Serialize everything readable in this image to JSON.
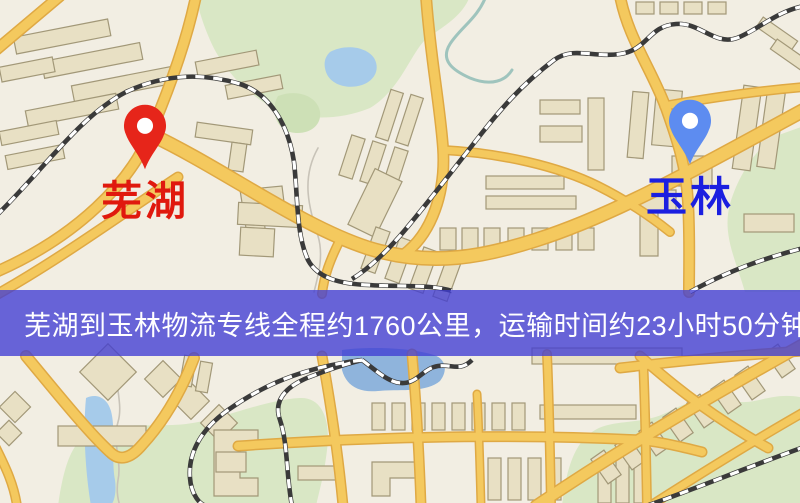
{
  "map_view": {
    "origin_marker": {
      "label": "芜湖",
      "pin_color": "#e6251a",
      "label_color": "#e0190e"
    },
    "destination_marker": {
      "label": "玉林",
      "pin_color": "#5d8cf0",
      "label_color": "#1b1fe0"
    },
    "banner": {
      "text": "芜湖到玉林物流专线全程约1760公里，运输时间约23小时50分钟.",
      "background_color": "rgba(64,60,212,0.78)",
      "text_color": "#ffffff"
    },
    "route_facts": {
      "origin": "芜湖",
      "destination": "玉林",
      "total_distance": "约1760公里",
      "transport_time": "约23小时50分钟"
    },
    "map_colors": {
      "background": "#f2eee3",
      "road": "#f4c95e",
      "road_casing": "#dfa944",
      "building": "#e8e0c4",
      "green_area": "#d9e7c5",
      "water": "#a6cbea",
      "railway_dark": "#3a3a3a"
    }
  }
}
